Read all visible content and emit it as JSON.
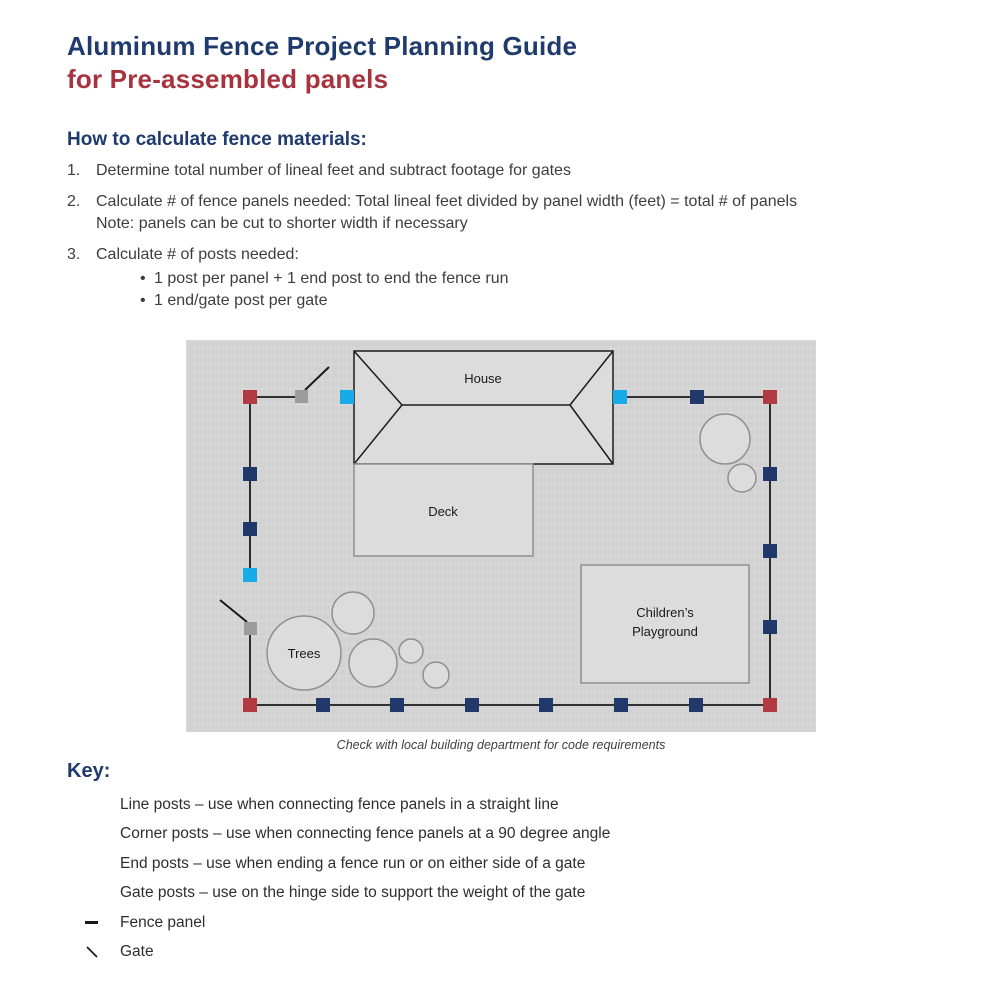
{
  "page": {
    "title_line1": "Aluminum Fence Project Planning Guide",
    "title_line2": "for Pre-assembled panels",
    "section_heading": "How to calculate fence materials:",
    "steps": [
      {
        "number": "1.",
        "text": "Determine total number of lineal feet and subtract footage for gates"
      },
      {
        "number": "2.",
        "text": "Calculate # of fence panels needed: Total lineal feet divided by panel width (feet) = total # of panels",
        "note": "Note: panels can be cut to shorter width if necessary"
      },
      {
        "number": "3.",
        "text": "Calculate # of posts needed:",
        "bullets": [
          {
            "dot": "•",
            "text": "1 post per panel + 1 end post to end the fence run"
          },
          {
            "dot": "•",
            "text": "1 end/gate post per gate"
          }
        ]
      }
    ],
    "caption": "Check with local building department for code requirements"
  },
  "diagram": {
    "labels": {
      "house": "House",
      "deck": "Deck",
      "playground_line1": "Children’s",
      "playground_line2": "Playground",
      "playground_full": "Children’s Playground",
      "trees": "Trees"
    },
    "post_counts": {
      "line_posts": 12,
      "corner_posts": 4,
      "end_posts": 3,
      "gate_posts": 2,
      "gates": 2
    },
    "colors": {
      "line_post": "#20396a",
      "corner_post": "#b23a42",
      "end_post": "#17ace8",
      "gate_post": "#9c9c9c",
      "fence_line": "#1a1a1a",
      "grid_background": "#d2d2d2",
      "grid_line": "#e0e0e0",
      "building_fill": "#dcdcdc"
    }
  },
  "key": {
    "heading": "Key:",
    "items": [
      {
        "id": "line-post",
        "swatch": "#20396a",
        "label": "Line posts – use when connecting fence panels in a straight line"
      },
      {
        "id": "corner-post",
        "swatch": "#b23a42",
        "label": "Corner posts – use when connecting fence panels at a 90 degree angle"
      },
      {
        "id": "end-post",
        "swatch": "#17ace8",
        "label": "End posts – use when ending a fence run or on either side of a gate"
      },
      {
        "id": "gate-post",
        "swatch": "#9c9c9c",
        "label": "Gate posts – use on the hinge side to support the weight of the gate"
      },
      {
        "id": "fence-panel",
        "label": "Fence panel"
      },
      {
        "id": "gate",
        "label": "Gate"
      }
    ]
  },
  "theme": {
    "title_navy": "#1f3a6c",
    "title_red": "#a8333f",
    "body_text": "#3d3d3d"
  }
}
